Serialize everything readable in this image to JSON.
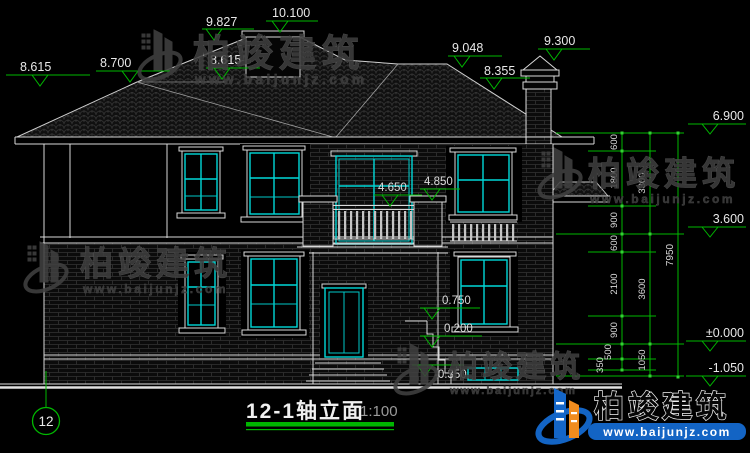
{
  "drawing": {
    "title": "12-1轴立面",
    "scale": "1:100",
    "axis_bubble": "12",
    "elevation_markers": [
      "8.615",
      "8.700",
      "9.827",
      "10.100",
      "8.615",
      "9.048",
      "8.355",
      "9.300",
      "6.900",
      "3.600",
      "±0.000",
      "-1.050",
      "4.650",
      "4.850",
      "0.750",
      "0.200",
      "-0.350"
    ],
    "dim_chain_inner": [
      "600",
      "1800",
      "900",
      "600",
      "2100",
      "900",
      "500",
      "350"
    ],
    "dim_chain_mid": [
      "3300",
      "3600",
      "1050"
    ],
    "dim_total": "7950",
    "colors": {
      "background": "#000000",
      "line_white": "#d9d9d9",
      "dimension_green": "#00b800",
      "glazing_cyan": "#00d8d8",
      "watermark_gray": "#3e3e3e",
      "brand_blue": "#1364c4",
      "brand_orange": "#f08c1e"
    }
  },
  "watermark": {
    "brand": "柏竣建筑",
    "url": "www.baijunjz.com"
  },
  "logo": {
    "brand": "柏竣建筑",
    "url": "www.baijunjz.com"
  }
}
